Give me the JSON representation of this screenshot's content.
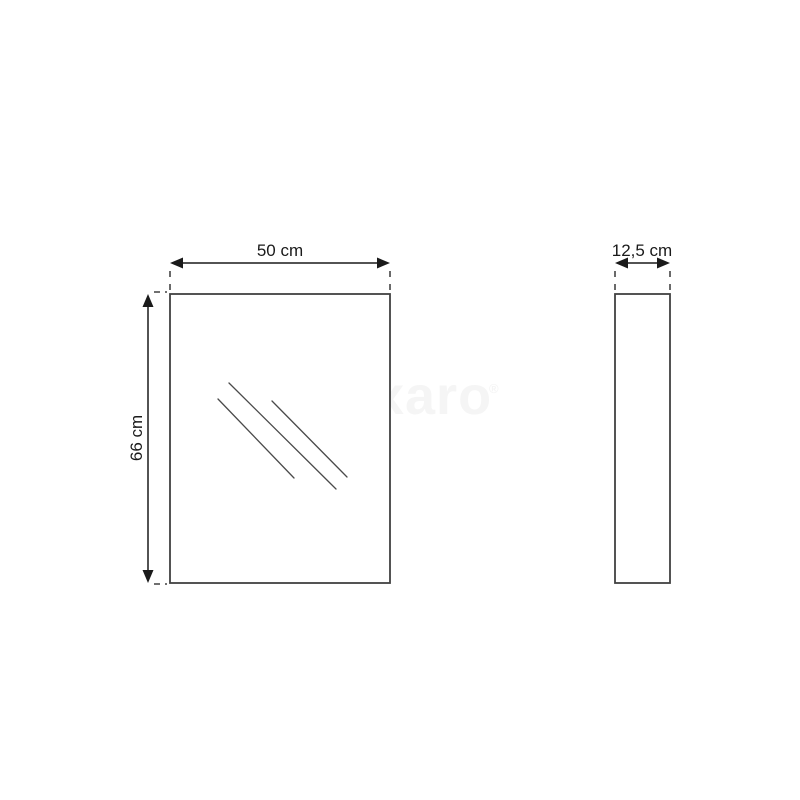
{
  "drawing": {
    "type": "product-dimension-diagram",
    "views": {
      "front": {
        "name": "front view of mirror cabinet",
        "width_dimension": {
          "label": "50 cm"
        },
        "height_dimension": {
          "label": "66 cm"
        }
      },
      "side": {
        "name": "side view of mirror cabinet",
        "depth_dimension": {
          "label": "12,5 cm"
        }
      }
    },
    "watermark": {
      "text": "maxaro",
      "mark": "®"
    }
  },
  "colors": {
    "background": "#ffffff",
    "outline": "#414141",
    "hatch": "#4a4a4a",
    "dimension": "#1a1a1a",
    "watermark": "#f5f5f5"
  }
}
